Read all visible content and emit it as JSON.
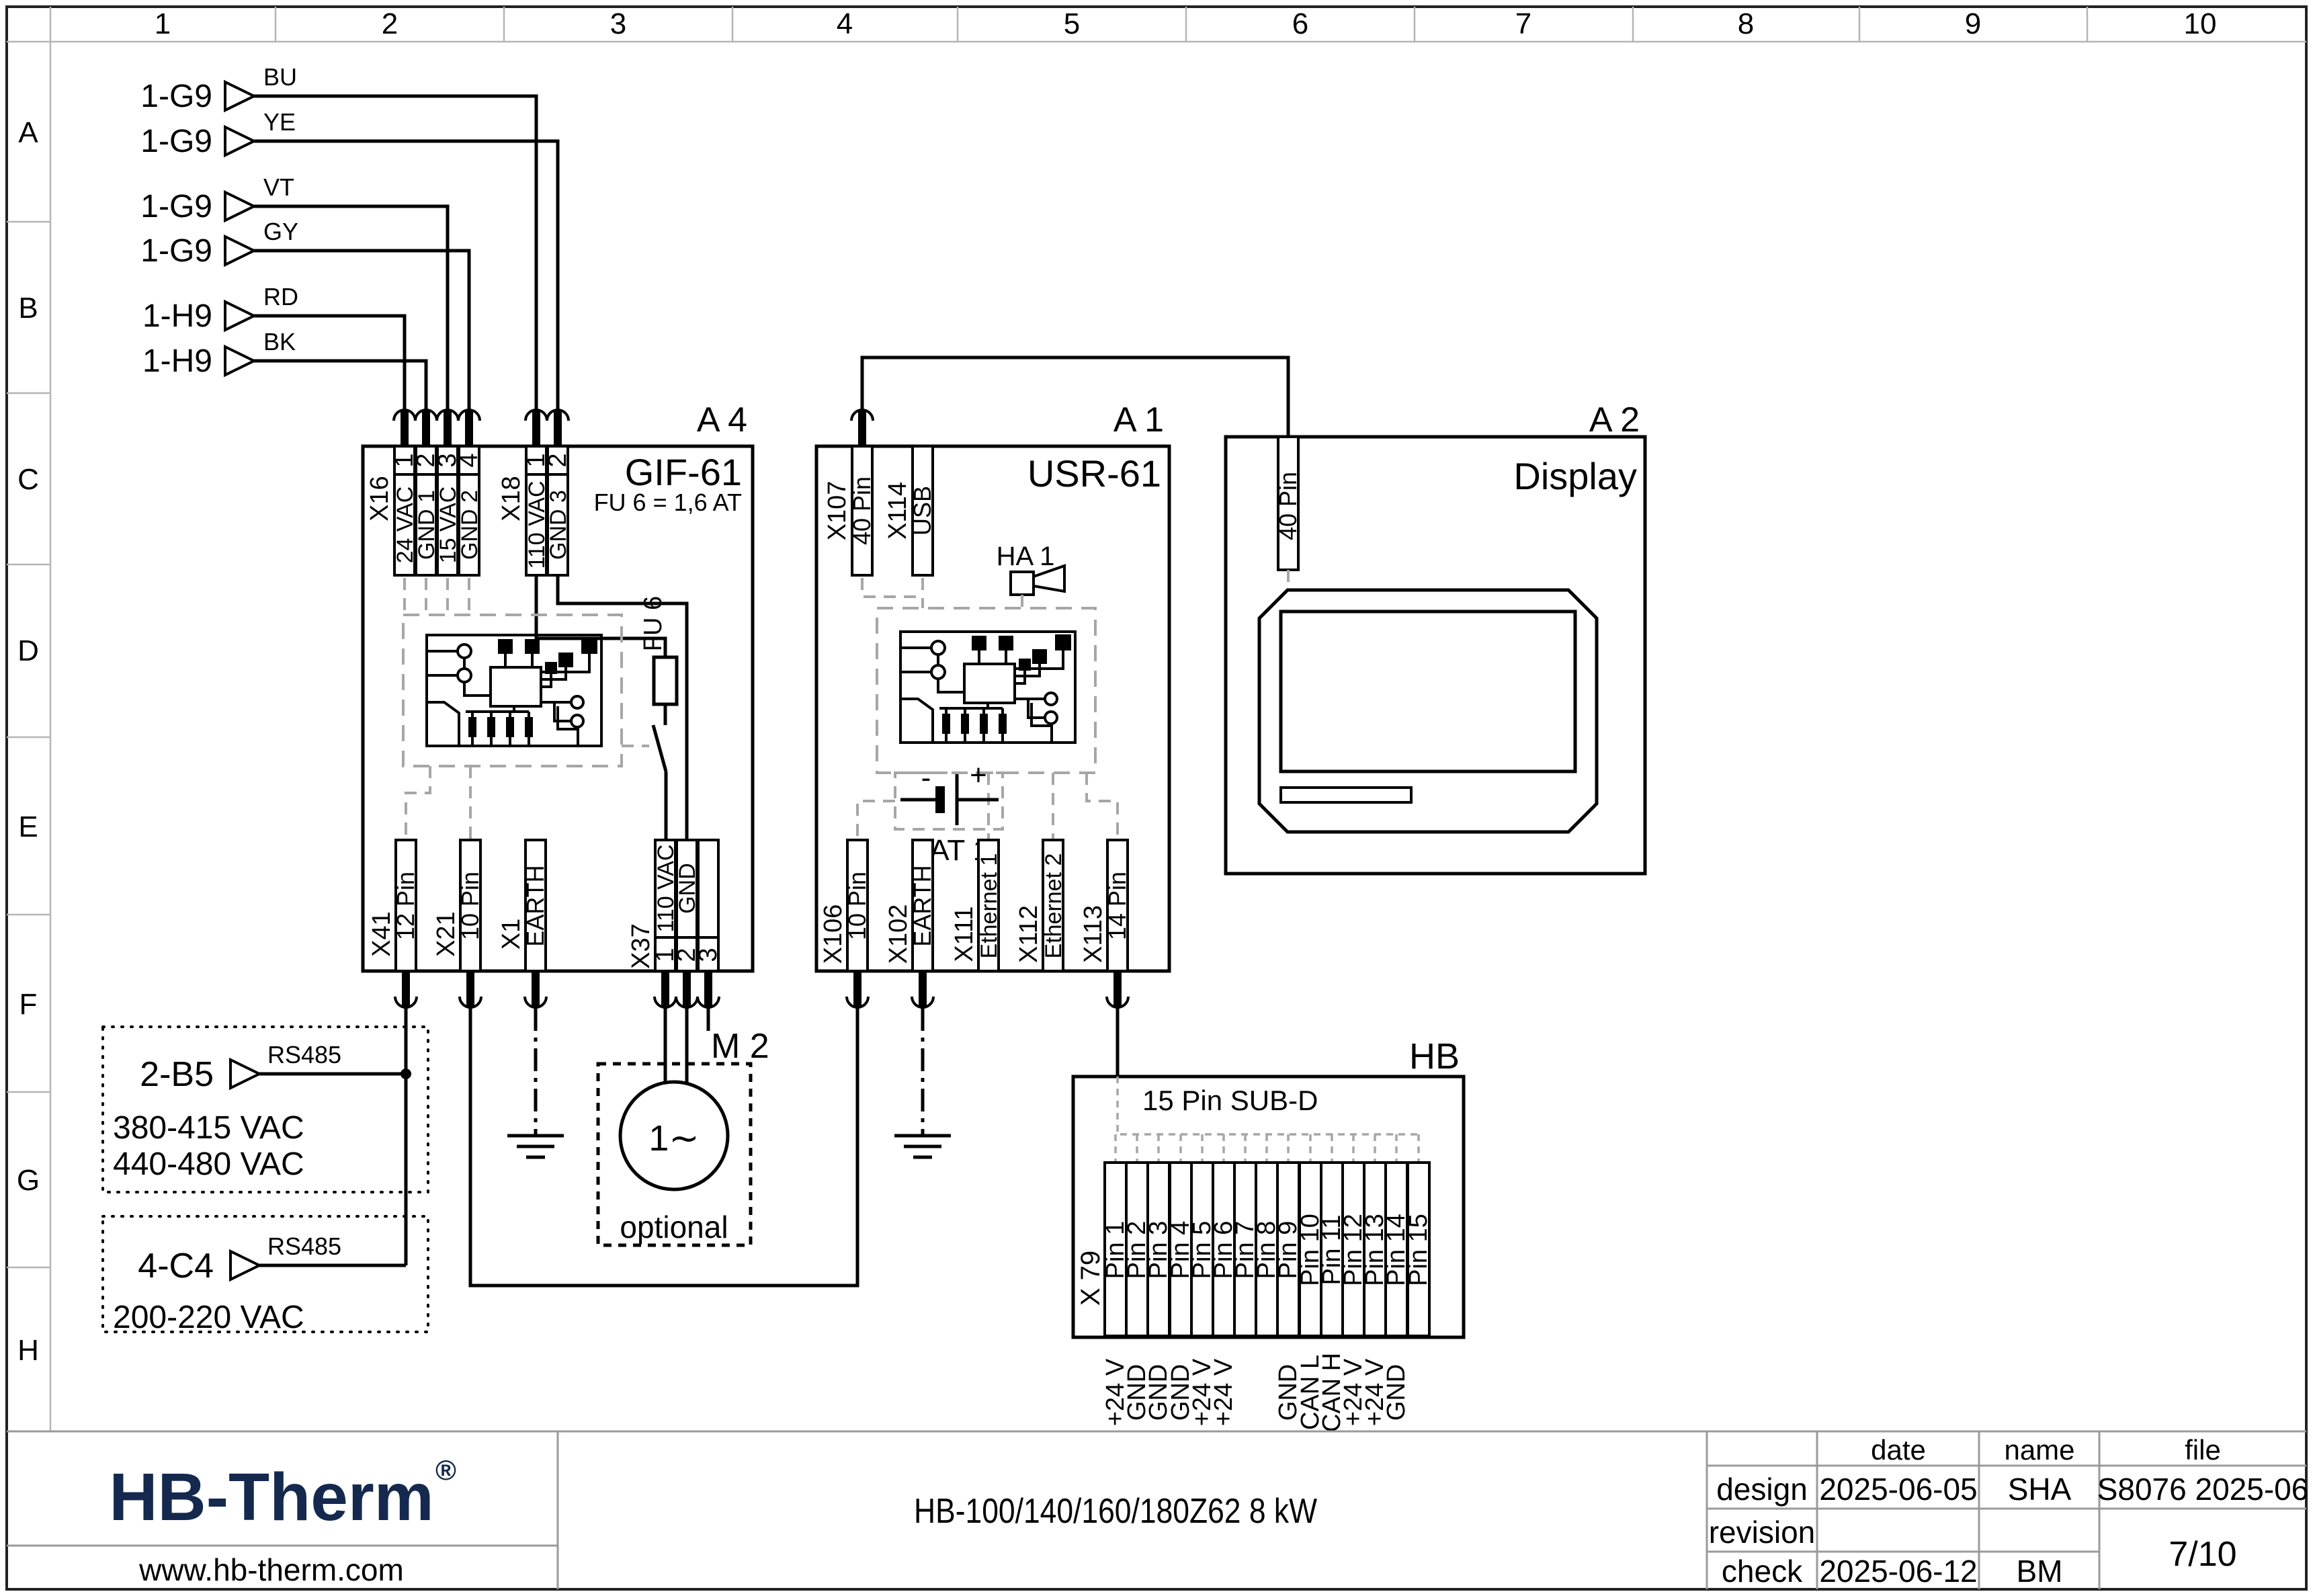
{
  "grid": {
    "columns": [
      "1",
      "2",
      "3",
      "4",
      "5",
      "6",
      "7",
      "8",
      "9",
      "10"
    ],
    "rows": [
      "A",
      "B",
      "C",
      "D",
      "E",
      "F",
      "G",
      "H"
    ]
  },
  "inputs": [
    {
      "tag": "1-G9",
      "color": "BU"
    },
    {
      "tag": "1-G9",
      "color": "YE"
    },
    {
      "tag": "1-G9",
      "color": "VT"
    },
    {
      "tag": "1-G9",
      "color": "GY"
    },
    {
      "tag": "1-H9",
      "color": "RD"
    },
    {
      "tag": "1-H9",
      "color": "BK"
    }
  ],
  "rs485": {
    "bus": "RS485",
    "top": {
      "tag": "2-B5",
      "v1": "380-415 VAC",
      "v2": "440-480 VAC"
    },
    "bottom": {
      "tag": "4-C4",
      "v1": "200-220 VAC"
    }
  },
  "a4": {
    "ref": "A 4",
    "name": "GIF-61",
    "fuse_note": "FU 6 = 1,6 AT",
    "fuse": "FU 6",
    "x16": {
      "name": "X16",
      "p1": "1",
      "p2": "2",
      "p3": "3",
      "p4": "4",
      "l1": "24 VAC",
      "l2": "GND 1",
      "l3": "15 VAC",
      "l4": "GND 2"
    },
    "x18": {
      "name": "X18",
      "p1": "1",
      "p2": "2",
      "l1": "110 VAC",
      "l2": "GND 3"
    },
    "x41": {
      "name": "X41",
      "label": "12 Pin"
    },
    "x21": {
      "name": "X21",
      "label": "10 Pin"
    },
    "x1": {
      "name": "X1",
      "label": "EARTH"
    },
    "x37": {
      "name": "X37",
      "p1": "1",
      "p2": "2",
      "p3": "3",
      "l1": "110 VAC",
      "l2": "GND"
    }
  },
  "a1": {
    "ref": "A 1",
    "name": "USR-61",
    "horn": "HA 1",
    "battery": "BAT 1",
    "minus": "-",
    "plus": "+",
    "x107": {
      "name": "X107",
      "label": "40 Pin"
    },
    "x114": {
      "name": "X114",
      "label": "USB"
    },
    "x106": {
      "name": "X106",
      "label": "10 Pin"
    },
    "x102": {
      "name": "X102",
      "label": "EARTH"
    },
    "x111": {
      "name": "X111",
      "label": "Ethernet 1"
    },
    "x112": {
      "name": "X112",
      "label": "Ethernet 2"
    },
    "x113": {
      "name": "X113",
      "label": "14 Pin"
    }
  },
  "a2": {
    "ref": "A 2",
    "name": "Display",
    "connector": "40 Pin"
  },
  "m2": {
    "ref": "M 2",
    "phase": "1∼",
    "note": "optional"
  },
  "hb": {
    "ref": "HB",
    "sub_d": "15 Pin SUB-D",
    "name": "X 79",
    "pins": [
      "Pin 1",
      "Pin 2",
      "Pin 3",
      "Pin 4",
      "Pin 5",
      "Pin 6",
      "Pin 7",
      "Pin 8",
      "Pin 9",
      "Pin 10",
      "Pin 11",
      "Pin 12",
      "Pin 13",
      "Pin 14",
      "Pin 15"
    ],
    "signals": [
      "+24 V",
      "GND",
      "GND",
      "GND",
      "+24 V",
      "+24 V",
      "",
      "",
      "GND",
      "CAN L",
      "CAN H",
      "+24 V",
      "+24 V",
      "GND",
      ""
    ]
  },
  "title_block": {
    "logo": "HB-Therm",
    "reg": "®",
    "website": "www.hb-therm.com",
    "title": "HB-100/140/160/180Z62 8 kW",
    "col_date": "date",
    "col_name": "name",
    "col_file": "file",
    "row_design": "design",
    "row_revision": "revision",
    "row_check": "check",
    "design_date": "2025-06-05",
    "design_name": "SHA",
    "file_value": "S8076 2025-06",
    "check_date": "2025-06-12",
    "check_name": "BM",
    "page": "7/10"
  }
}
